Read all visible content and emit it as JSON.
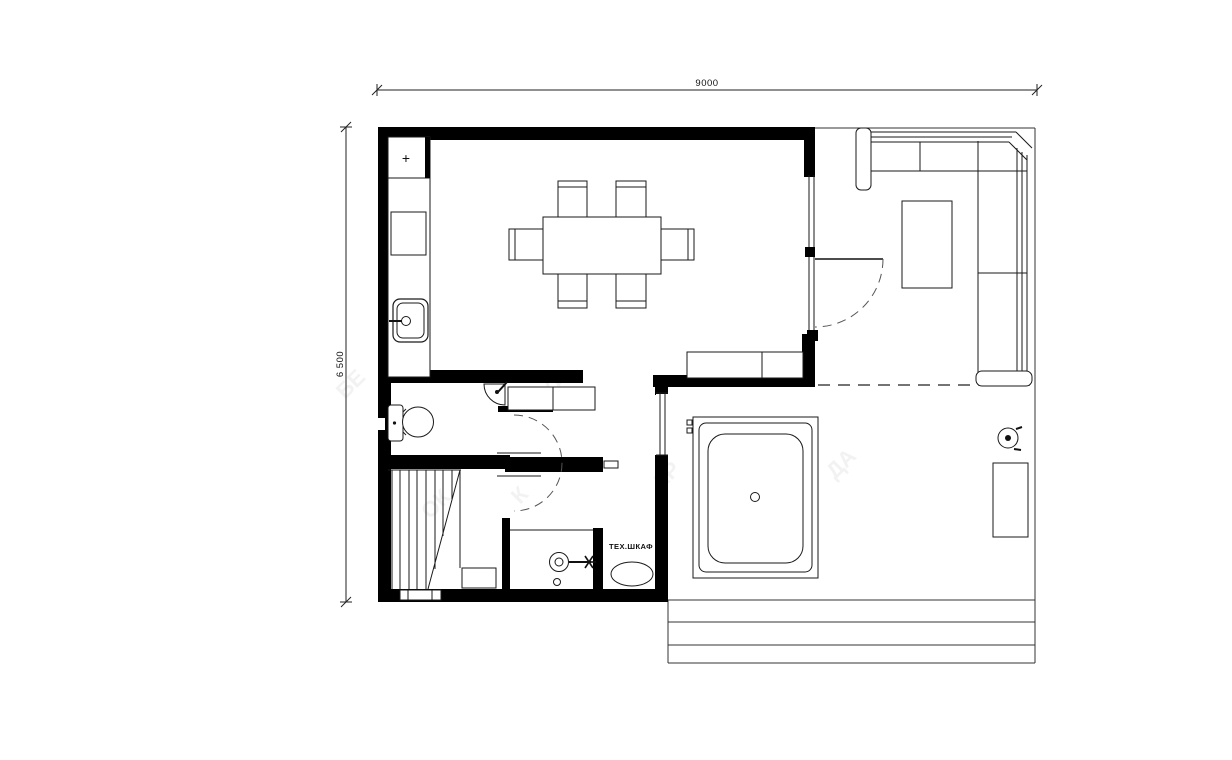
{
  "plan": {
    "dimensions": {
      "width_label": "9000",
      "height_label": "6 500"
    },
    "labels": {
      "tech_cabinet": "ТЕХ.ШКАФ",
      "hob_marker": "+"
    },
    "watermarks": [
      "БЕ",
      "ЖА",
      "К",
      "АР",
      "ДА",
      "ОК"
    ],
    "colors": {
      "wall": "#000000",
      "furniture_line": "#1a1a1a",
      "outdoor_line": "#333333",
      "dashed_line": "#555555",
      "dimension_line": "#222222",
      "background": "#ffffff",
      "watermark": "#8a8a8a"
    }
  }
}
